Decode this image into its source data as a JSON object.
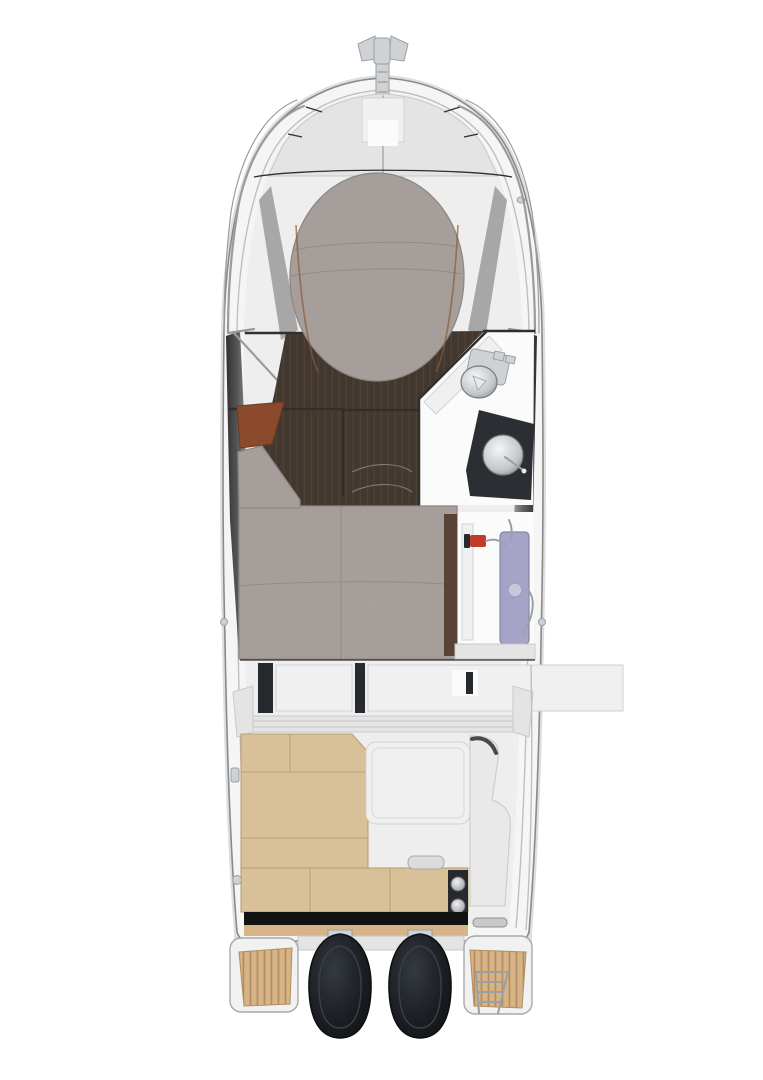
{
  "figure": {
    "kind": "boat-deck-plan-top-view",
    "vessel_label": "powerboat-deck-plan"
  },
  "colors": {
    "background": "#ffffff",
    "hull_outline": "#8a8a8a",
    "hull_fill": "#f5f5f5",
    "deck_white": "#eeeeee",
    "rail": "#9b9b9b",
    "structure_line": "#2f2f2f",
    "sunpad_gray": "#a8a09c",
    "sunpad_seam": "#8e8680",
    "wood_dark": "#42382f",
    "wood_grain": "#55483c",
    "brown_panel": "#8b4a2c",
    "tan_upholstery": "#d8c099",
    "tan_seam": "#bba173",
    "teak": "#d7b488",
    "teak_stripe": "#b28e5e",
    "counter_dark": "#2b2e32",
    "engine_dark": "#1b1e23",
    "lavender_panel": "#a5a4c7",
    "extinguisher_red": "#c23a2a",
    "metal_light": "#cfd2d5",
    "metal_mid": "#9aa0a5"
  },
  "parts": {
    "bow": [
      "anchor-roller",
      "bow-rail-port",
      "bow-rail-starboard",
      "foredeck-hatch",
      "bow-sunpad"
    ],
    "cabin": [
      "v-berth-floor",
      "berth-footwell",
      "storage-panel",
      "head-toilet",
      "head-sink",
      "head-vanity",
      "head-door"
    ],
    "midship": [
      "mid-cabin-berth",
      "companionway-steps",
      "cabin-door-panel",
      "fire-extinguisher"
    ],
    "cockpit": [
      "cockpit-table",
      "l-shaped-settee",
      "aft-bench",
      "bench-hatch-handle",
      "helm-seat-module",
      "transom-panel"
    ],
    "stern": [
      "port-engine",
      "starboard-engine",
      "port-swim-platform",
      "starboard-swim-platform",
      "swim-ladder",
      "transom-grab-bar"
    ]
  }
}
